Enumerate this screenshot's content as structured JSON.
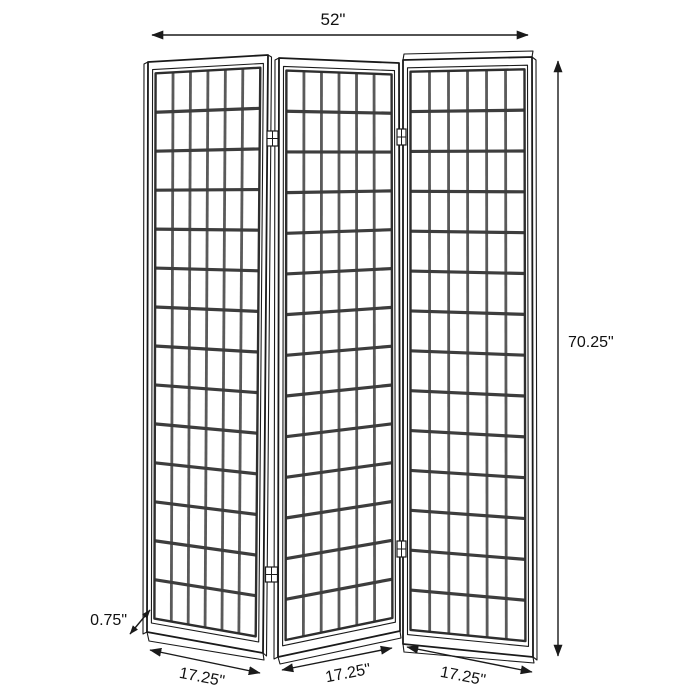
{
  "page": {
    "background_color": "#ffffff"
  },
  "diagram": {
    "subject": "3-panel folding screen room divider with window-pane grid panels",
    "dimensions": {
      "overall_width": "52\"",
      "overall_height": "70.25\"",
      "panel_thickness": "0.75\"",
      "panel_widths": [
        "17.25\"",
        "17.25\"",
        "17.25\""
      ]
    },
    "panels": {
      "count": 3,
      "grid_columns": 6,
      "grid_rows": 14
    },
    "colors": {
      "outline": "#1a1a1a",
      "grid_horizontal": "#3d3d3d",
      "grid_vertical": "#5a5a5a",
      "label_text": "#111111",
      "background": "#ffffff"
    }
  }
}
